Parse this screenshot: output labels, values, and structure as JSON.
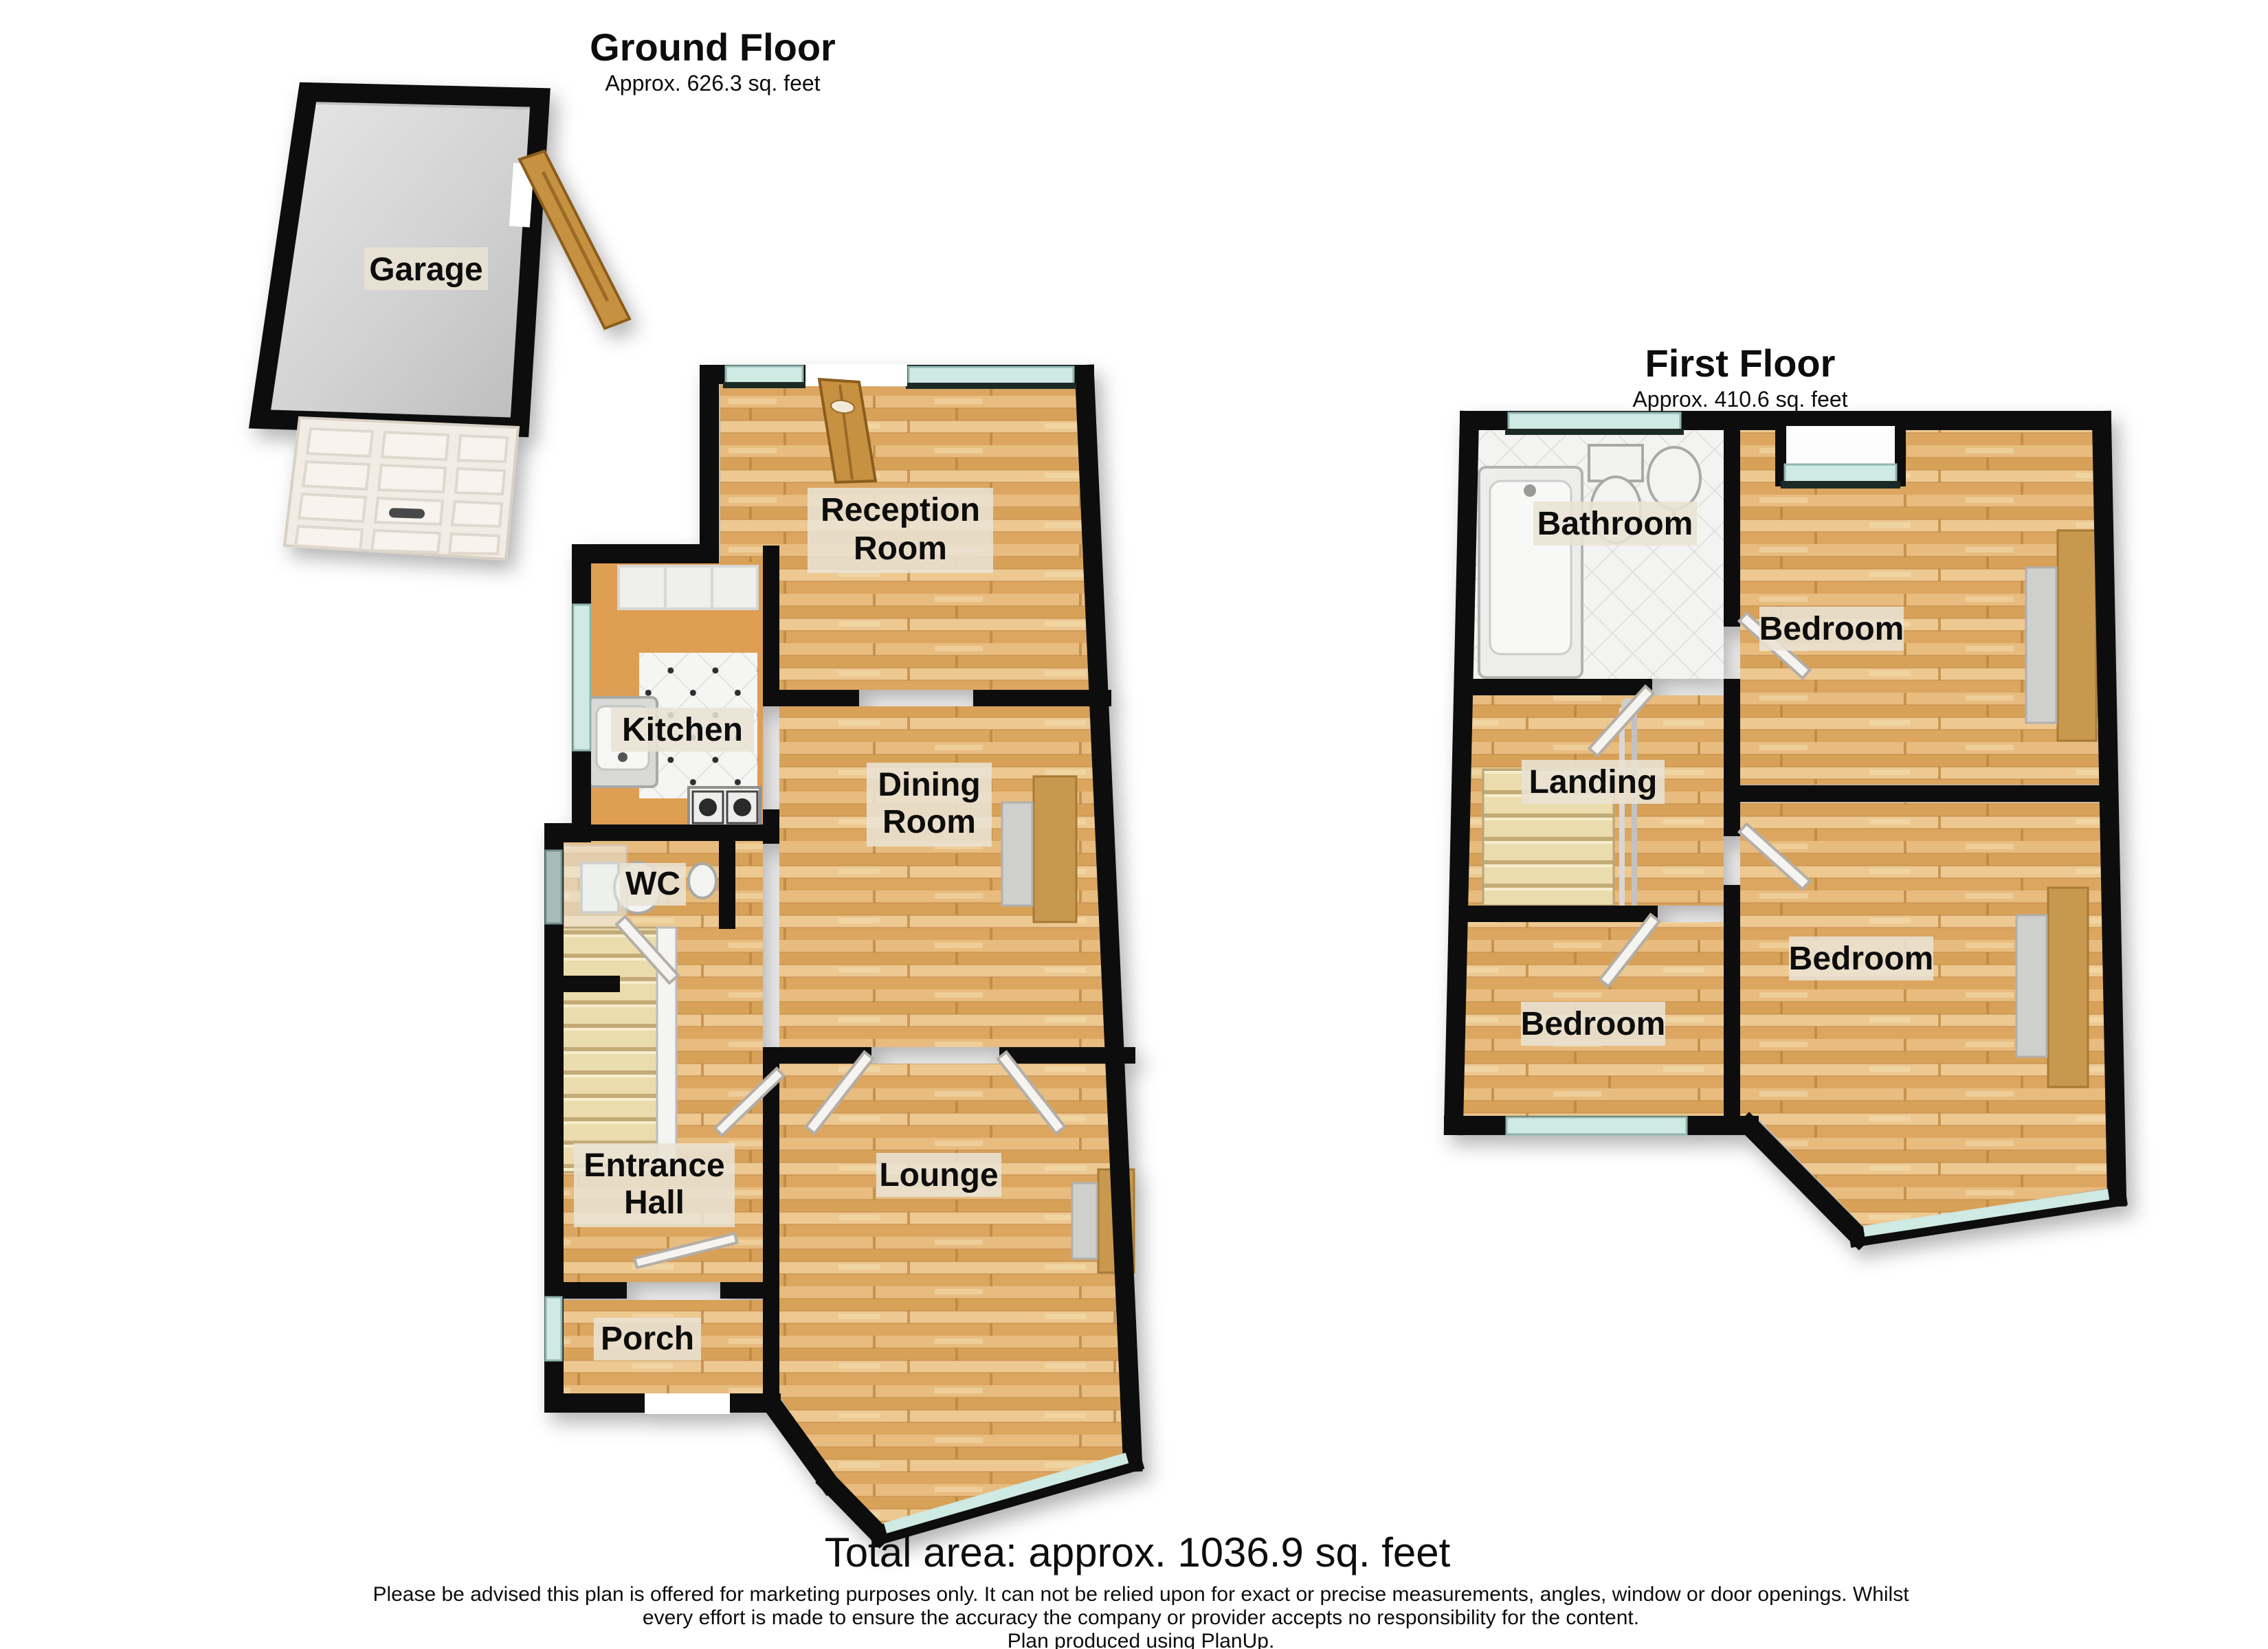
{
  "ground_floor": {
    "title": "Ground Floor",
    "subtitle": "Approx. 626.3 sq. feet",
    "rooms": {
      "garage": "Garage",
      "reception_line1": "Reception",
      "reception_line2": "Room",
      "kitchen": "Kitchen",
      "dining_line1": "Dining",
      "dining_line2": "Room",
      "wc": "WC",
      "entrance_line1": "Entrance",
      "entrance_line2": "Hall",
      "lounge": "Lounge",
      "porch": "Porch"
    }
  },
  "first_floor": {
    "title": "First Floor",
    "subtitle": "Approx. 410.6 sq. feet",
    "rooms": {
      "bathroom": "Bathroom",
      "bedroom_top": "Bedroom",
      "landing": "Landing",
      "bedroom_left": "Bedroom",
      "bedroom_right": "Bedroom"
    }
  },
  "footer": {
    "total_area": "Total area: approx. 1036.9 sq. feet",
    "disclaimer_line1": "Please be advised this plan is offered for marketing purposes only. It can not be relied upon for exact or precise measurements, angles, window or door openings. Whilst",
    "disclaimer_line2": "every effort is made to ensure the accuracy the company or provider accepts no responsibility for the content.",
    "disclaimer_line3": "Plan produced using PlanUp."
  },
  "colors": {
    "wall": "#0d0d0d",
    "wood_floor": "#dfae69",
    "window_glass": "#cfe9e3",
    "garage_floor": "#cccccc",
    "label_bg": "#e9e2d4",
    "door_wood": "#c6913f"
  }
}
